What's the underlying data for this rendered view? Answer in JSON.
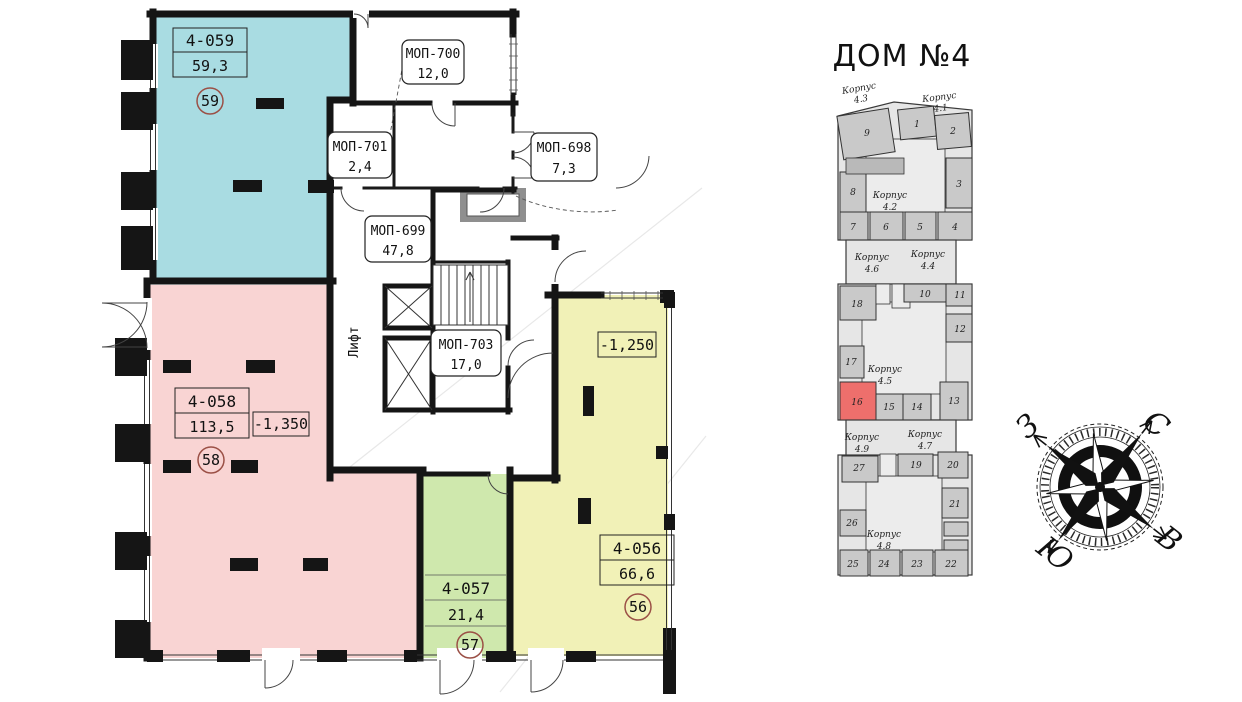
{
  "floor_plan": {
    "units": [
      {
        "id": "4-059",
        "area": "59,3",
        "number": "59",
        "color": "#a9dce2"
      },
      {
        "id": "4-058",
        "area": "113,5",
        "number": "58",
        "elevation": "-1,350",
        "color": "#f9d4d3"
      },
      {
        "id": "4-057",
        "area": "21,4",
        "number": "57",
        "color": "#cfe8ad"
      },
      {
        "id": "4-056",
        "area": "66,6",
        "number": "56",
        "elevation": "-1,250",
        "color": "#f1f1b7"
      }
    ],
    "common_areas": [
      {
        "id": "МОП-700",
        "area": "12,0"
      },
      {
        "id": "МОП-701",
        "area": "2,4"
      },
      {
        "id": "МОП-698",
        "area": "7,3"
      },
      {
        "id": "МОП-699",
        "area": "47,8"
      },
      {
        "id": "МОП-703",
        "area": "17,0"
      }
    ],
    "elevator_label": "Лифт"
  },
  "locator": {
    "title": "ДОМ №4",
    "korpus": [
      {
        "word": "Корпус",
        "num": "4.3"
      },
      {
        "word": "Корпус",
        "num": "4.1"
      },
      {
        "word": "Корпус",
        "num": "4.2"
      },
      {
        "word": "Корпус",
        "num": "4.6"
      },
      {
        "word": "Корпус",
        "num": "4.4"
      },
      {
        "word": "Корпус",
        "num": "4.5"
      },
      {
        "word": "Корпус",
        "num": "4.9"
      },
      {
        "word": "Корпус",
        "num": "4.7"
      },
      {
        "word": "Корпус",
        "num": "4.8"
      }
    ],
    "cells": [
      "1",
      "2",
      "3",
      "4",
      "5",
      "6",
      "7",
      "8",
      "9",
      "10",
      "11",
      "12",
      "13",
      "14",
      "15",
      "16",
      "17",
      "18",
      "19",
      "20",
      "21",
      "22",
      "23",
      "24",
      "25",
      "26",
      "27"
    ],
    "highlighted_cell": "16",
    "highlight_color": "#ee6f6c"
  },
  "compass": {
    "north": "С",
    "east": "В",
    "south": "Ю",
    "west": "З"
  }
}
